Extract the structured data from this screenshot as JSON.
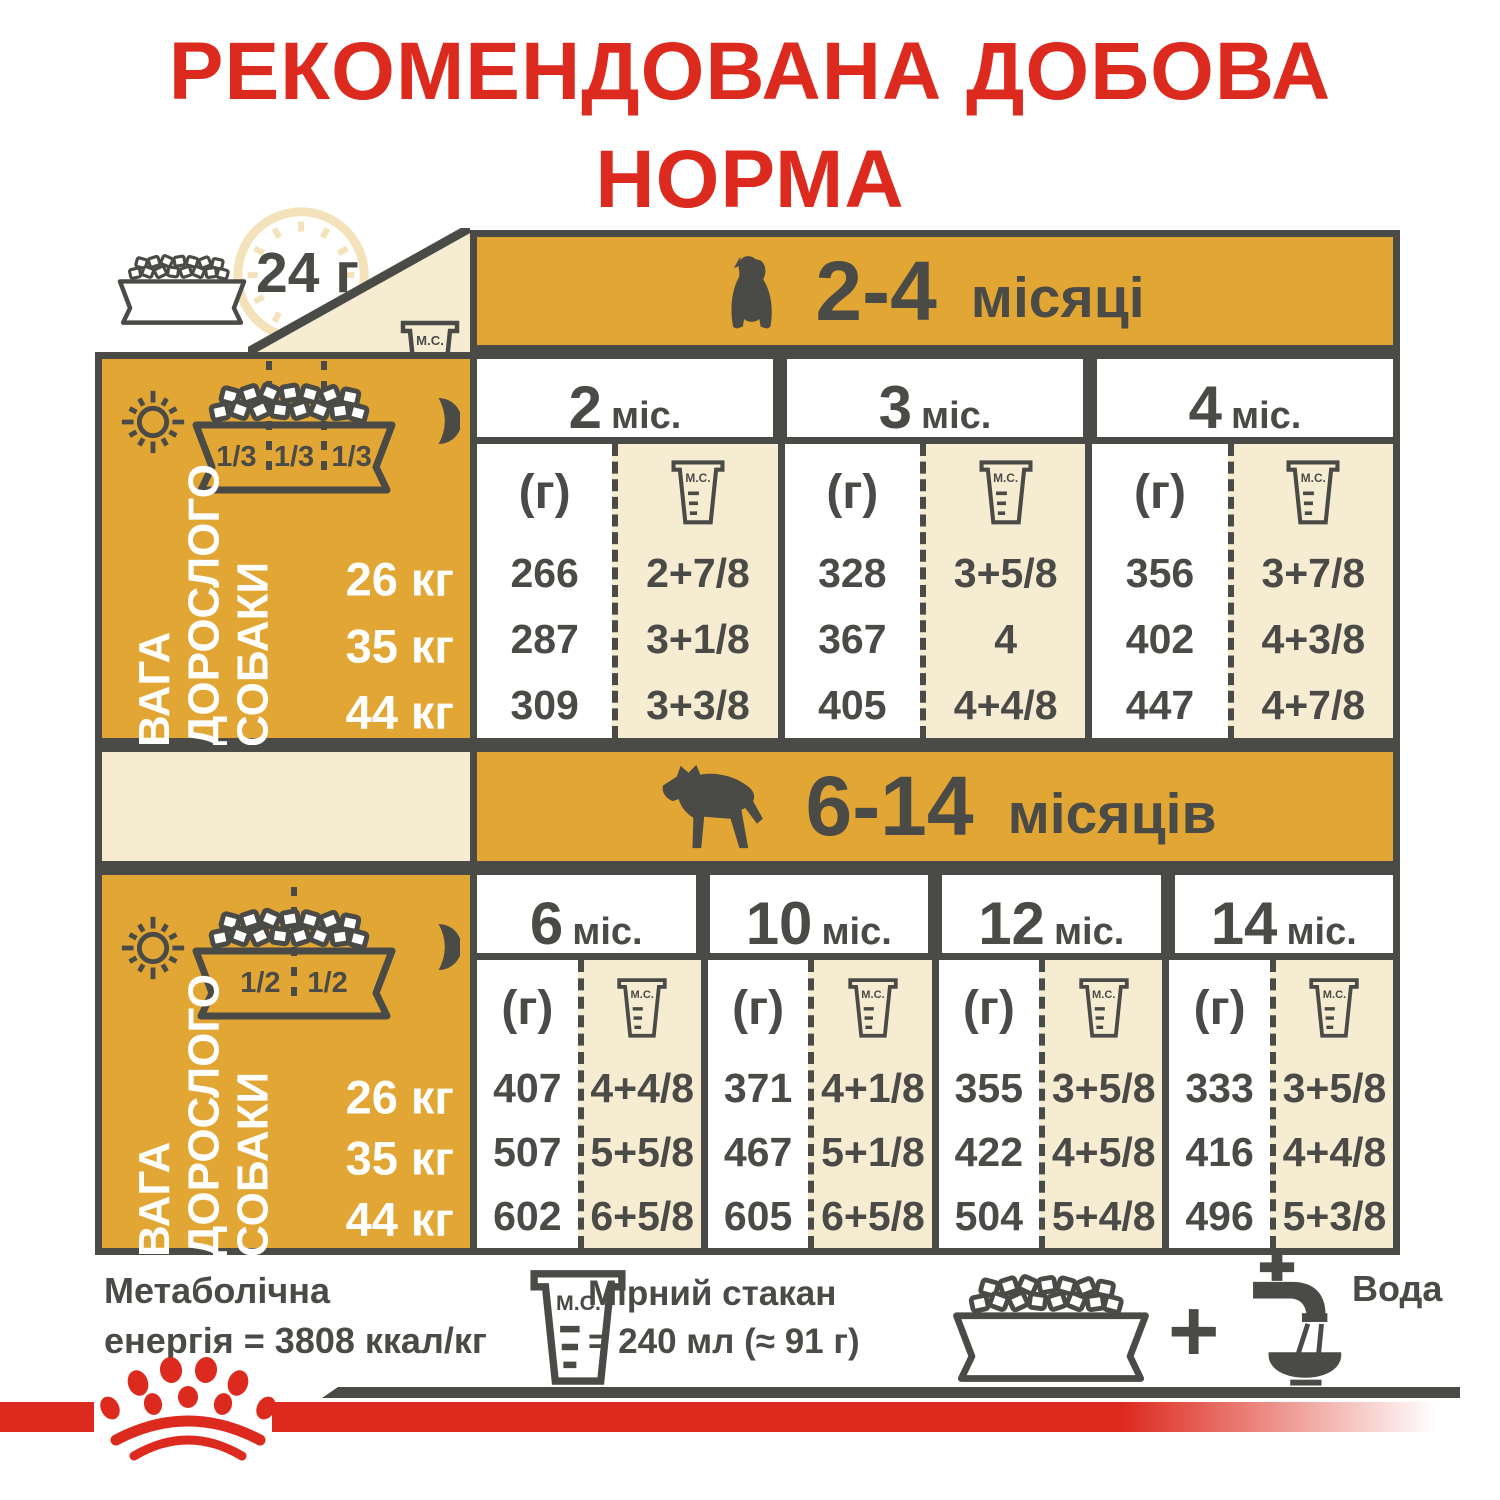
{
  "title": {
    "line1": "РЕКОМЕНДОВАНА ДОБОВА",
    "line2": "НОРМА"
  },
  "top": {
    "daily_label": "24 г"
  },
  "cup_label": "М.С.",
  "gram_header": "(г)",
  "weight_label": "ВАГА\nДОРОСЛОГО\nСОБАКИ",
  "weights": [
    "26 кг",
    "35 кг",
    "44 кг"
  ],
  "sidebar1": {
    "fractions": [
      "1/3",
      "1/3",
      "1/3"
    ]
  },
  "sidebar2": {
    "fractions": [
      "1/2",
      "1/2"
    ]
  },
  "section1": {
    "title_range": "2-4",
    "title_word": "місяці",
    "columns": [
      {
        "num": "2",
        "unit": "міс."
      },
      {
        "num": "3",
        "unit": "міс."
      },
      {
        "num": "4",
        "unit": "міс."
      }
    ],
    "rows": [
      {
        "weight": "26 кг",
        "cells": [
          {
            "g": "266",
            "cups": "2+7/8"
          },
          {
            "g": "328",
            "cups": "3+5/8"
          },
          {
            "g": "356",
            "cups": "3+7/8"
          }
        ]
      },
      {
        "weight": "35 кг",
        "cells": [
          {
            "g": "287",
            "cups": "3+1/8"
          },
          {
            "g": "367",
            "cups": "4"
          },
          {
            "g": "402",
            "cups": "4+3/8"
          }
        ]
      },
      {
        "weight": "44 кг",
        "cells": [
          {
            "g": "309",
            "cups": "3+3/8"
          },
          {
            "g": "405",
            "cups": "4+4/8"
          },
          {
            "g": "447",
            "cups": "4+7/8"
          }
        ]
      }
    ]
  },
  "section2": {
    "title_range": "6-14",
    "title_word": "місяців",
    "columns": [
      {
        "num": "6",
        "unit": "міс."
      },
      {
        "num": "10",
        "unit": "міс."
      },
      {
        "num": "12",
        "unit": "міс."
      },
      {
        "num": "14",
        "unit": "міс."
      }
    ],
    "rows": [
      {
        "weight": "26 кг",
        "cells": [
          {
            "g": "407",
            "cups": "4+4/8"
          },
          {
            "g": "371",
            "cups": "4+1/8"
          },
          {
            "g": "355",
            "cups": "3+5/8"
          },
          {
            "g": "333",
            "cups": "3+5/8"
          }
        ]
      },
      {
        "weight": "35 кг",
        "cells": [
          {
            "g": "507",
            "cups": "5+5/8"
          },
          {
            "g": "467",
            "cups": "5+1/8"
          },
          {
            "g": "422",
            "cups": "4+5/8"
          },
          {
            "g": "416",
            "cups": "4+4/8"
          }
        ]
      },
      {
        "weight": "44 кг",
        "cells": [
          {
            "g": "602",
            "cups": "6+5/8"
          },
          {
            "g": "605",
            "cups": "6+5/8"
          },
          {
            "g": "504",
            "cups": "5+4/8"
          },
          {
            "g": "496",
            "cups": "5+3/8"
          }
        ]
      }
    ]
  },
  "footer": {
    "energy_line1": "Метаболічна",
    "energy_line2": "енергія = 3808 ккал/кг",
    "cup_line1": "Мірний стакан",
    "cup_line2": "= 240 мл (≈ 91 г)",
    "plus": "+",
    "water_label": "Вода"
  },
  "colors": {
    "gold": "#E2A634",
    "cream": "#F5ECD2",
    "dark": "#4A4A47",
    "red": "#DD2A1E"
  }
}
